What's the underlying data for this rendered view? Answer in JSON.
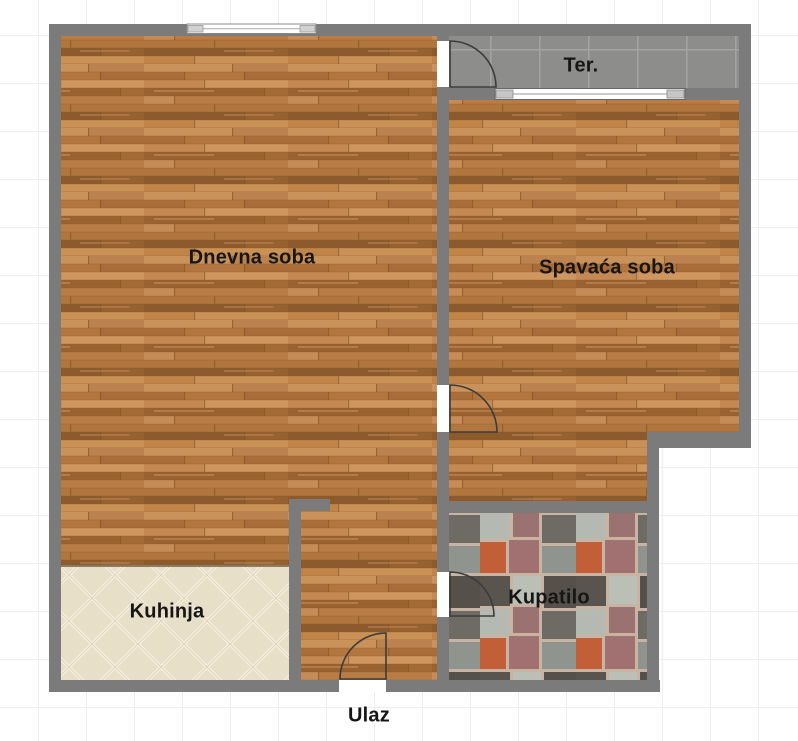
{
  "plan": {
    "title": "Apartment floor plan",
    "rooms": [
      {
        "id": "dnevna-soba",
        "label": "Dnevna soba",
        "floor": "wood"
      },
      {
        "id": "spavaca-soba",
        "label": "Spavaća soba",
        "floor": "wood"
      },
      {
        "id": "terasa",
        "label": "Ter.",
        "floor": "gray-tile"
      },
      {
        "id": "kuhinja",
        "label": "Kuhinja",
        "floor": "beige-diamond-tile"
      },
      {
        "id": "kupatilo",
        "label": "Kupatilo",
        "floor": "mosaic-tile"
      },
      {
        "id": "ulaz",
        "label": "Ulaz",
        "floor": "entrance"
      }
    ],
    "colors": {
      "wall": "#7b7b7b",
      "wood_base": "#bd7f49",
      "terrace_tile": "#8c8c8c",
      "kitchen_tile": "#e8dfc8",
      "bathroom_grout": "#c9b3a3",
      "label_text": "#161616",
      "grid_line": "#ededed",
      "background": "#ffffff"
    }
  }
}
